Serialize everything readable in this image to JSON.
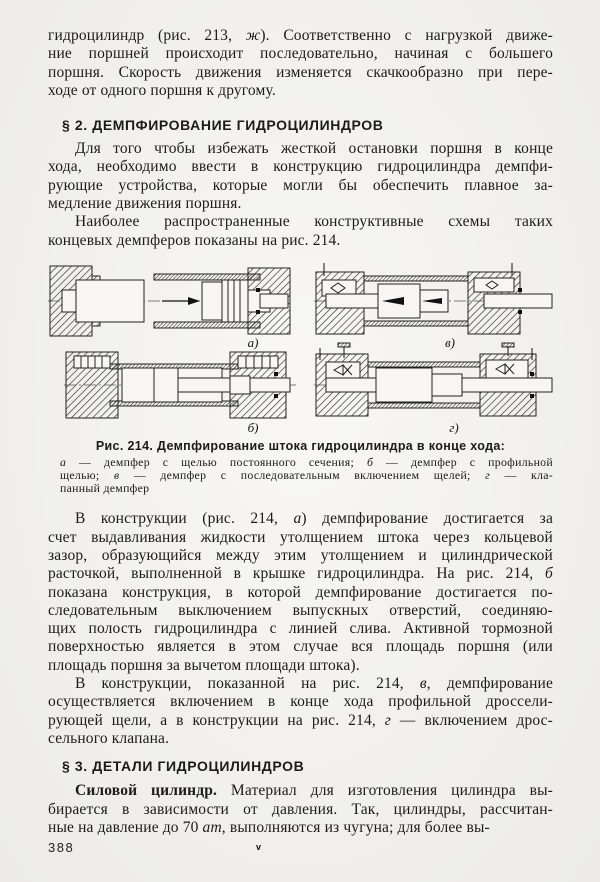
{
  "colors": {
    "paper": "#f4f3ef",
    "ink": "#1b1b1b"
  },
  "page": {
    "number": "388",
    "printer_mark": "v"
  },
  "sections": {
    "intro_lines": [
      "гидроцилиндр (рис. 213, <i>ж</i>). Соответственно с нагрузкой движе-",
      "ние поршней происходит последовательно, начиная с большего",
      "поршня. Скорость движения изменяется скачкообразно при пере-",
      "ходе от одного поршня к другому."
    ],
    "heading_s2": "§ 2. ДЕМПФИРОВАНИЕ ГИДРОЦИЛИНДРОВ",
    "s2_para1_lines": [
      "Для того чтобы избежать жесткой остановки поршня в конце",
      "хода, необходимо ввести в конструкцию гидроцилиндра демпфи-",
      "рующие устройства, которые могли бы обеспечить плавное за-",
      "медление движения поршня."
    ],
    "s2_para2_lines": [
      "Наиболее распространенные конструктивные схемы таких",
      "концевых демпферов показаны на рис. 214."
    ],
    "s2_para3_lines": [
      "В конструкции (рис. 214, <i>а</i>) демпфирование достигается за",
      "счет выдавливания жидкости утолщением штока через кольцевой",
      "зазор, образующийся между этим утолщением и цилиндрической",
      "расточкой, выполненной в крышке гидроцилиндра. На рис. 214, <i>б</i>",
      "показана конструкция, в которой демпфирование достигается по-",
      "следовательным выключением выпускных отверстий, соединяю-",
      "щих полость гидроцилиндра с линией слива. Активной тормозной",
      "поверхностью является в этом случае вся площадь поршня (или",
      "площадь поршня за вычетом площади штока)."
    ],
    "s2_para4_lines": [
      "В конструкции, показанной на рис. 214, <i>в</i>, демпфирование",
      "осуществляется включением в конце хода профильной дроссели-",
      "рующей щели, а в конструкции на рис. 214, <i>г</i> — включением дрос-",
      "сельного клапана."
    ],
    "heading_s3": "§ 3. ДЕТАЛИ ГИДРОЦИЛИНДРОВ",
    "s3_para1_lines": [
      "<b>Силовой цилиндр.</b> Материал для изготовления цилиндра вы-",
      "бирается в зависимости от давления. Так, цилиндры, рассчитан-",
      "ные на давление до 70 <i>ат</i>, выполняются из чугуна; для более вы-"
    ]
  },
  "figure": {
    "labels": [
      "а)",
      "в)",
      "б)",
      "г)"
    ],
    "caption_title": "Рис. 214. Демпфирование штока гидроцилиндра в конце хода:",
    "caption_legend_lines": [
      "<i>а</i> — демпфер с щелью постоянного сечения; <i>б</i> — демпфер с профильной",
      "щелью; <i>в</i> — демпфер с последовательным включением щелей; <i>г</i> — кла-",
      "панный демпфер"
    ]
  }
}
